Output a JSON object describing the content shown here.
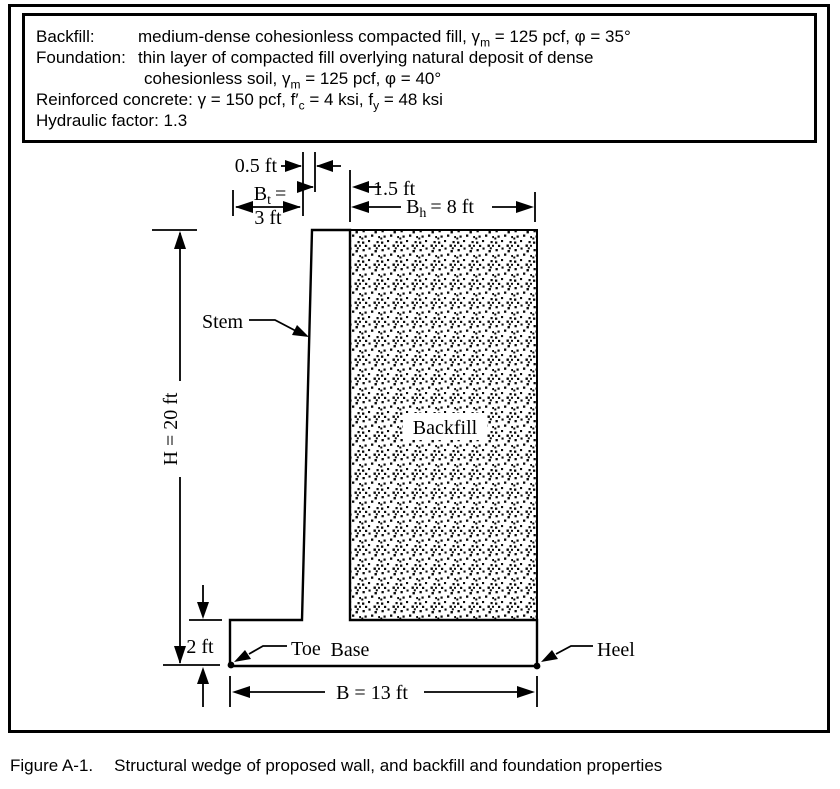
{
  "colors": {
    "ink": "#000000",
    "paper": "#ffffff"
  },
  "properties_box": {
    "backfill_label": "Backfill:",
    "backfill_text_1": "medium-dense cohesionless compacted fill, γ",
    "backfill_sub": "m",
    "backfill_text_2": " = 125 pcf, φ = 35°",
    "foundation_label": "Foundation:",
    "foundation_line1": "thin layer of compacted fill overlying natural deposit of dense",
    "foundation_line2_1": "cohesionless soil, γ",
    "foundation_sub": "m",
    "foundation_line2_2": " = 125 pcf, φ = 40°",
    "concrete_1": "Reinforced concrete: γ = 150 pcf, f′",
    "concrete_sub_c": "c",
    "concrete_2": " = 4 ksi, f",
    "concrete_sub_y": "y",
    "concrete_3": " = 48 ksi",
    "hydraulic": "Hydraulic factor: 1.3"
  },
  "diagram": {
    "dim_batter": "0.5 ft",
    "dim_toe_B": "B",
    "dim_toe_sub": "t",
    "dim_toe_eq": "=",
    "dim_toe_value": "3 ft",
    "dim_stem_top": "1.5 ft",
    "dim_heel_B": "B",
    "dim_heel_sub": "h",
    "dim_heel_eq": "= 8 ft",
    "dim_height": "H = 20 ft",
    "dim_base_thickness": "2 ft",
    "dim_base_width": "B = 13 ft",
    "label_stem": "Stem",
    "label_backfill": "Backfill",
    "label_toe": "Toe",
    "label_base": "Base",
    "label_heel": "Heel"
  },
  "caption": {
    "label": "Figure A-1.",
    "text": "Structural wedge of proposed wall, and backfill and foundation properties"
  }
}
